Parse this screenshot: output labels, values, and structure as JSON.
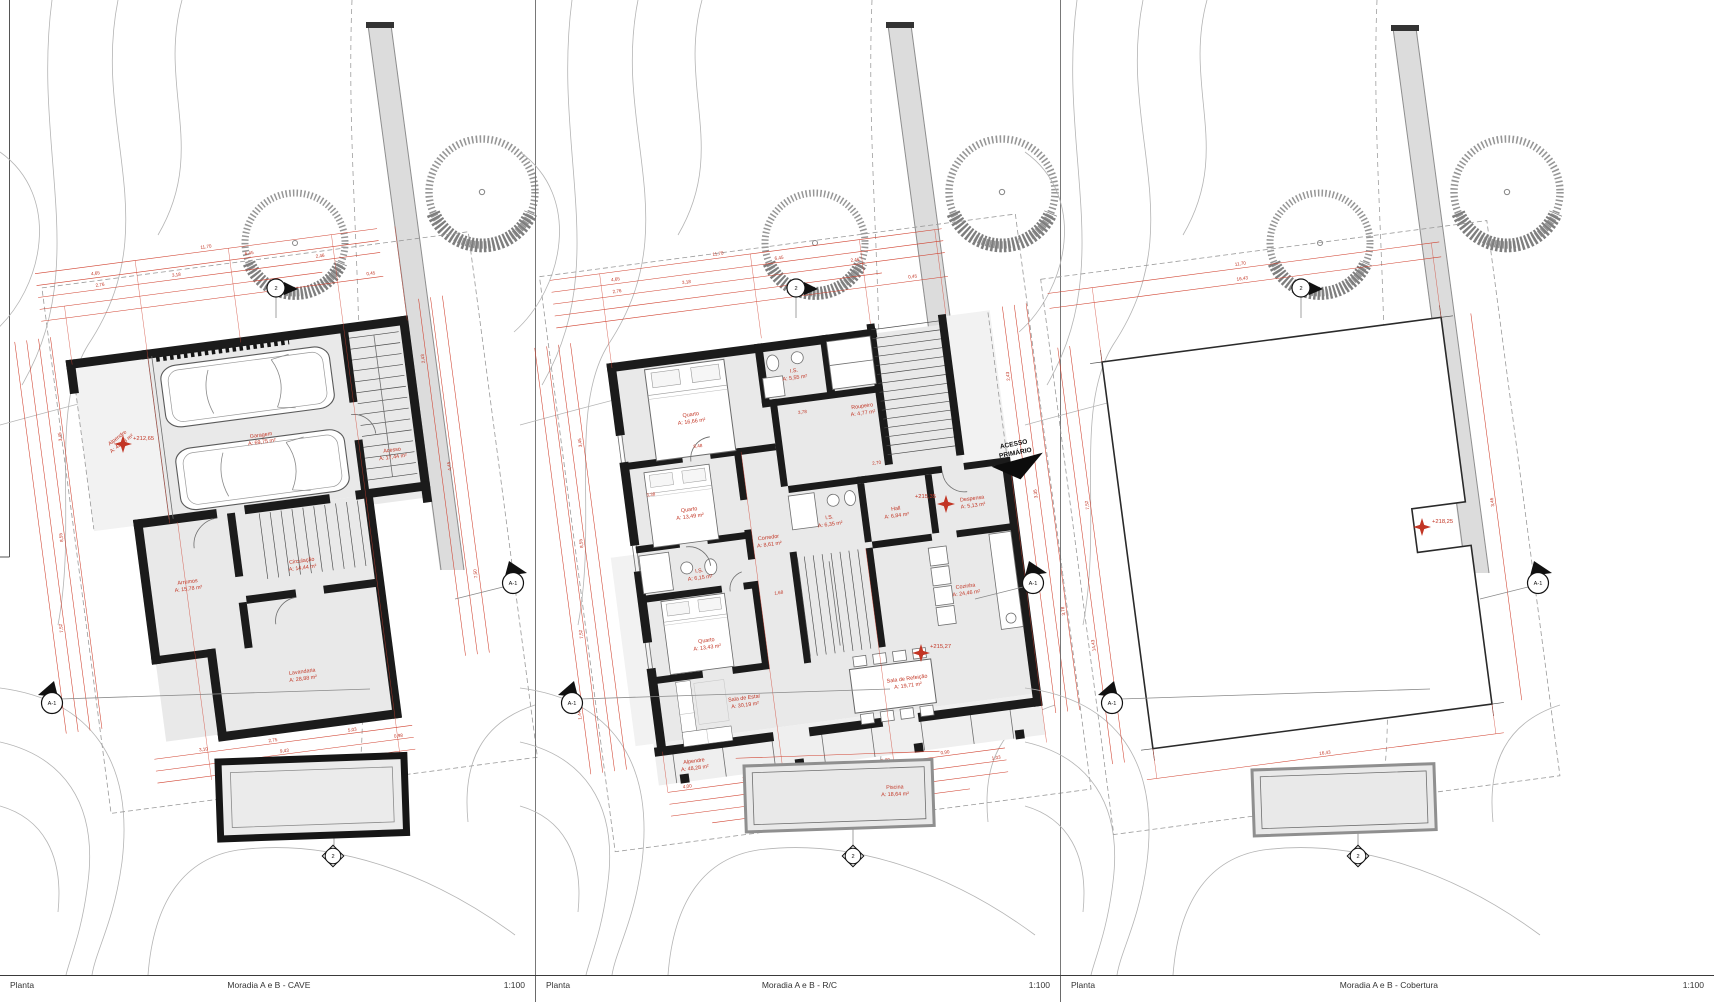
{
  "sheet": {
    "drawing_type": "Planta",
    "scale": "1:100"
  },
  "colors": {
    "dimension_red": "#c23524",
    "wall_black": "#1b1b1b",
    "floor_gray": "#e9e9e9",
    "contour_gray": "#b4b4b4",
    "road_gray": "#dcdcdc",
    "tree_gray": "#8f8f8f"
  },
  "panels": [
    {
      "footer": {
        "type": "Planta",
        "title": "Moradia A e B - CAVE",
        "scale": "1:100"
      },
      "level_marks": [
        "+212,65"
      ],
      "markers": {
        "left": "A-1",
        "right": "A-1",
        "top": "2",
        "bottom": "2"
      },
      "rooms": [
        {
          "name": "Alpendre",
          "area": "A: 43,43 m²"
        },
        {
          "name": "Garagem",
          "area": "A: 69,75 m²"
        },
        {
          "name": "Acesso",
          "area": "A: 17,44 m²"
        },
        {
          "name": "Arrumos",
          "area": "A: 15,78 m²"
        },
        {
          "name": "Circulação",
          "area": "A: 14,44 m²"
        },
        {
          "name": "Lavandaria",
          "area": "A: 28,88 m²"
        }
      ],
      "dims_top": [
        "11,70",
        "4,65",
        "6,45",
        "3,18",
        "2,76",
        "2,46",
        "0,45"
      ],
      "dims_left": [
        "3,45",
        "8,55",
        "7,52",
        "3,63"
      ],
      "dims_right": [
        "2,43",
        "4,45",
        "7,50"
      ],
      "dims_bottom": [
        "3,10",
        "2,75",
        "5,03",
        "0,98",
        "9,43",
        "12,70"
      ]
    },
    {
      "footer": {
        "type": "Planta",
        "title": "Moradia A e B - R/C",
        "scale": "1:100"
      },
      "level_marks": [
        "+215,35",
        "+215,27"
      ],
      "access_label_1": "ACESSO",
      "access_label_2": "PRIMÁRIO",
      "markers": {
        "left": "A-1",
        "right": "A-1",
        "top": "2",
        "bottom": "2"
      },
      "rooms": [
        {
          "name": "Quarto",
          "area": "A: 16,66 m²"
        },
        {
          "name": "I.S.",
          "area": "A: 5,55 m²"
        },
        {
          "name": "Roupeiro",
          "area": "A: 4,77 m²"
        },
        {
          "name": "Quarto",
          "area": "A: 13,49 m²"
        },
        {
          "name": "I.S.",
          "area": "A: 6,15 m²"
        },
        {
          "name": "Quarto",
          "area": "A: 13,43 m²"
        },
        {
          "name": "Corredor",
          "area": "A: 8,61 m²"
        },
        {
          "name": "I.S.",
          "area": "A: 6,35 m²"
        },
        {
          "name": "Hall",
          "area": "A: 6,84 m²"
        },
        {
          "name": "Despensa",
          "area": "A: 5,13 m²"
        },
        {
          "name": "Cozinha",
          "area": "A: 24,46 m²"
        },
        {
          "name": "Sala de Estar",
          "area": "A: 30,19 m²"
        },
        {
          "name": "Sala de Refeição",
          "area": "A: 19,71 m²"
        },
        {
          "name": "Alpendre",
          "area": "A: 48,28 m²"
        },
        {
          "name": "Piscina",
          "area": "A: 18,64 m²"
        }
      ],
      "dims_top": [
        "11,70",
        "4,65",
        "6,45",
        "3,18",
        "2,76",
        "2,46",
        "0,45"
      ],
      "dims_left": [
        "3,45",
        "8,55",
        "7,52",
        "1,44"
      ],
      "dims_right": [
        "2,43",
        "3,35",
        "3,78"
      ],
      "dims_bottom": [
        "4,00",
        "2,13",
        "4,45",
        "5,80",
        "0,90",
        "1,03",
        "14,50",
        "10,78",
        "13,04"
      ],
      "dims_inner": [
        "8,48",
        "3,78",
        "2,70",
        "3,38",
        "1,68"
      ]
    },
    {
      "footer": {
        "type": "Planta",
        "title": "Moradia A e B - Cobertura",
        "scale": "1:100"
      },
      "level_marks": [
        "+218,25"
      ],
      "markers": {
        "left": "A-1",
        "right": "A-1",
        "top": "2",
        "bottom": "2"
      },
      "dims_top": [
        "11,70",
        "16,43"
      ],
      "dims_left": [
        "7,52",
        "14,43"
      ],
      "dims_right": [
        "3,46"
      ],
      "dims_bottom": [
        "16,43"
      ]
    }
  ]
}
